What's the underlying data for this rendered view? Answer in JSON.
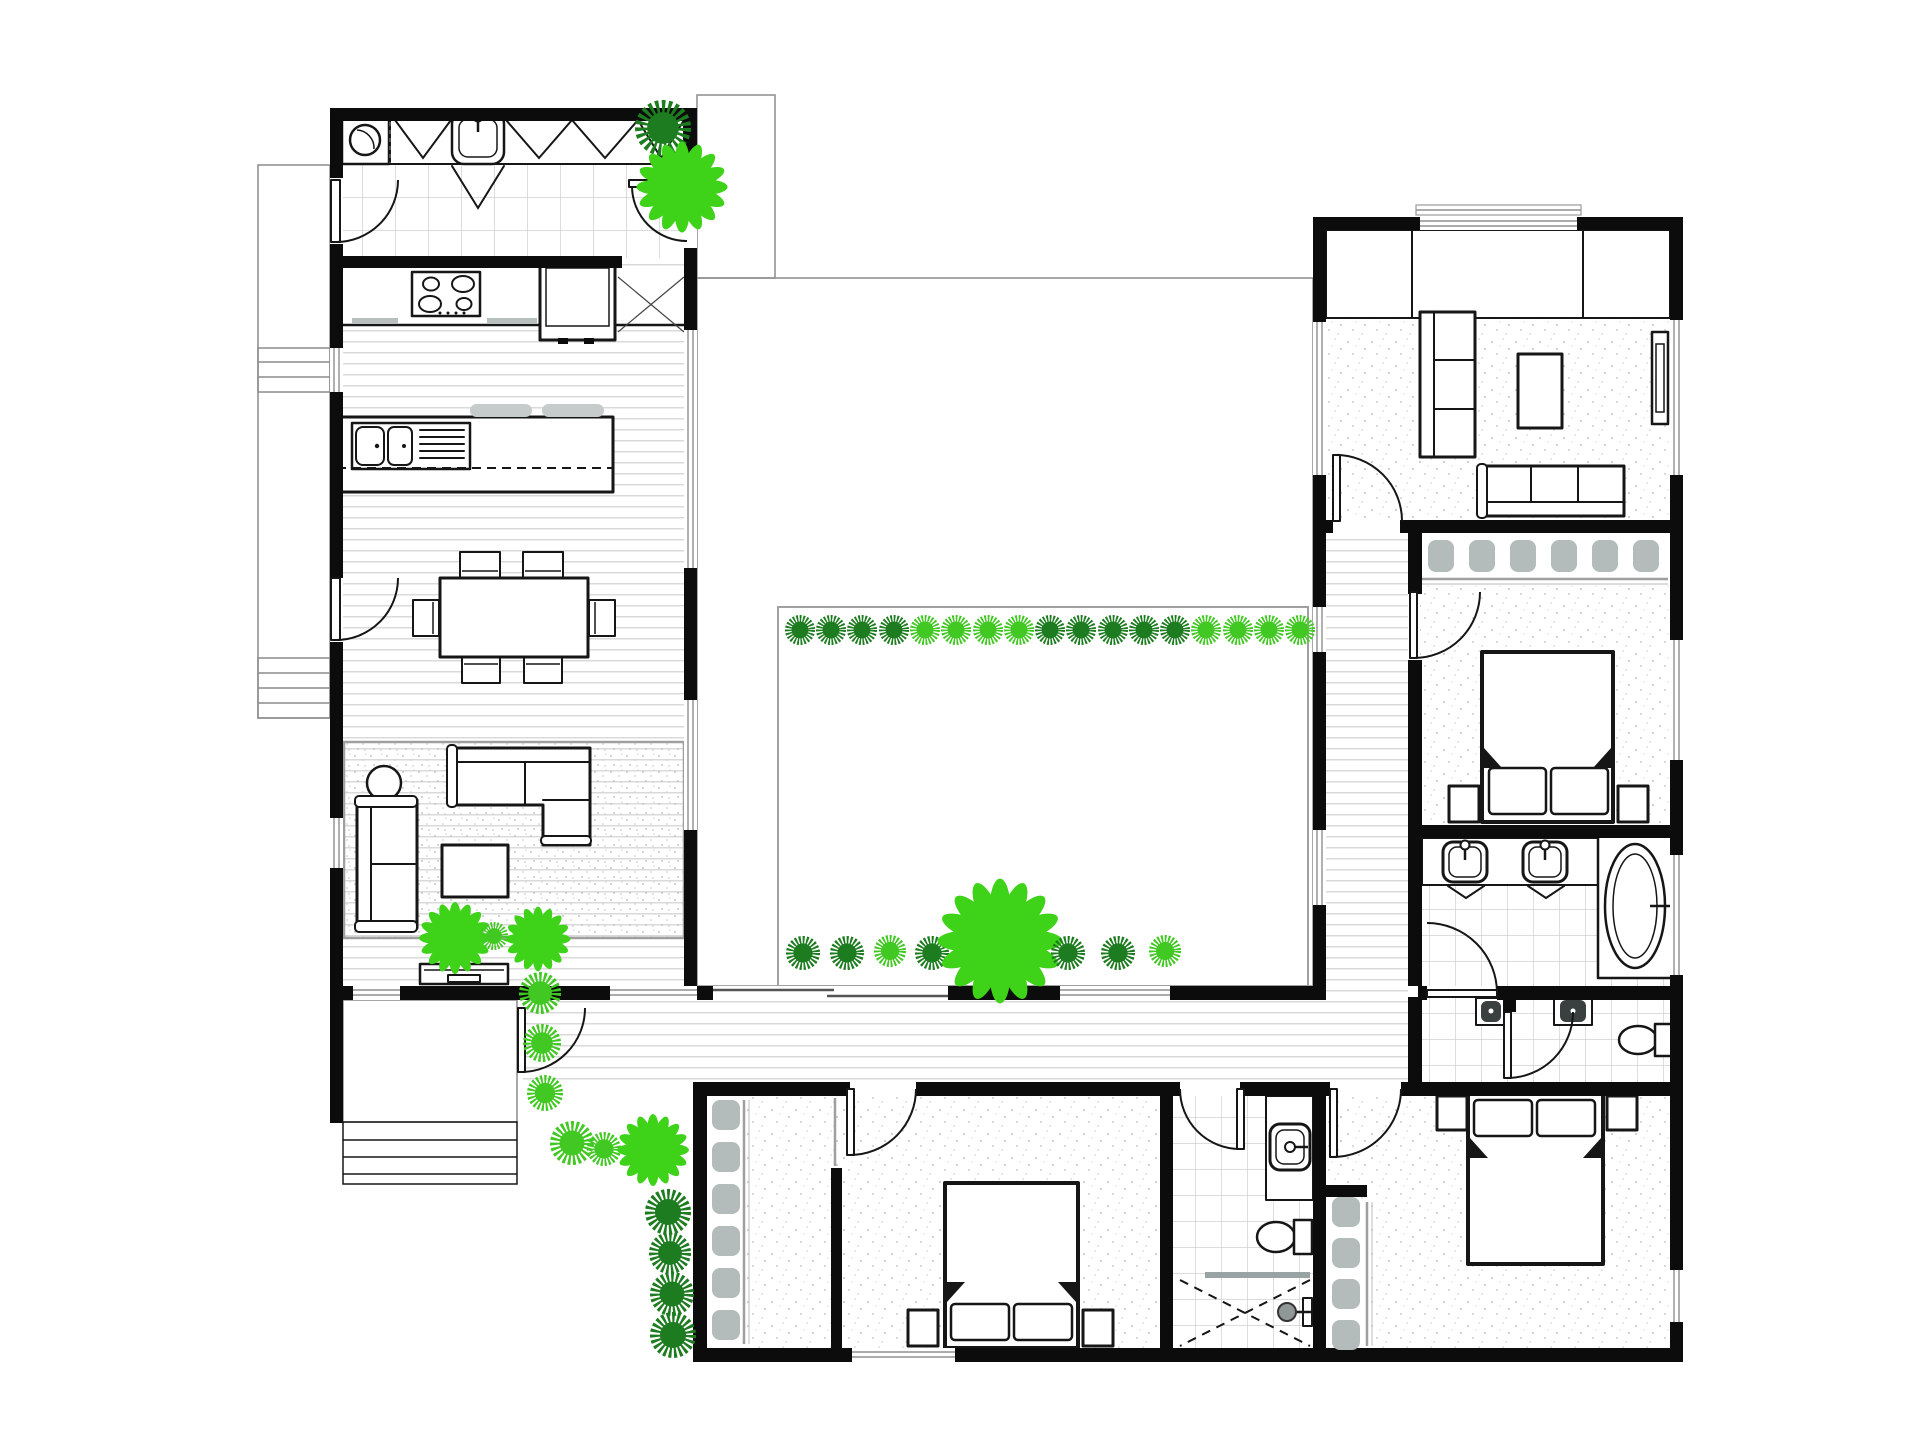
{
  "canvas": {
    "width": 1920,
    "height": 1440,
    "background": "#ffffff"
  },
  "palette": {
    "wall": "#0c0c0c",
    "line": "#161616",
    "glass": "#8f8f8f",
    "floor_line": "#dadada",
    "deck_line": "#c9c9c9",
    "tile_line": "#d0d0d0",
    "carpet_dot": "#cbcbcb",
    "gray_fixture": "#b4bbbb",
    "plant_dark": "#1d7c1f",
    "plant_light": "#41c822",
    "flower_light": "#3ed218"
  },
  "plants": [
    {
      "type": "bush",
      "shade": "dark",
      "x": 663,
      "y": 128,
      "r": 28
    },
    {
      "type": "flower",
      "shade": "light",
      "x": 682,
      "y": 187,
      "r": 38
    },
    {
      "type": "bush",
      "shade": "dark",
      "x": 800,
      "y": 630,
      "r": 15
    },
    {
      "type": "bush",
      "shade": "dark",
      "x": 831,
      "y": 630,
      "r": 15
    },
    {
      "type": "bush",
      "shade": "dark",
      "x": 862,
      "y": 630,
      "r": 15
    },
    {
      "type": "bush",
      "shade": "dark",
      "x": 894,
      "y": 630,
      "r": 15
    },
    {
      "type": "bush",
      "shade": "light",
      "x": 925,
      "y": 630,
      "r": 15
    },
    {
      "type": "bush",
      "shade": "light",
      "x": 956,
      "y": 630,
      "r": 15
    },
    {
      "type": "bush",
      "shade": "light",
      "x": 988,
      "y": 630,
      "r": 15
    },
    {
      "type": "bush",
      "shade": "light",
      "x": 1019,
      "y": 630,
      "r": 15
    },
    {
      "type": "bush",
      "shade": "dark",
      "x": 1050,
      "y": 630,
      "r": 15
    },
    {
      "type": "bush",
      "shade": "dark",
      "x": 1081,
      "y": 630,
      "r": 15
    },
    {
      "type": "bush",
      "shade": "dark",
      "x": 1113,
      "y": 630,
      "r": 15
    },
    {
      "type": "bush",
      "shade": "dark",
      "x": 1144,
      "y": 630,
      "r": 15
    },
    {
      "type": "bush",
      "shade": "dark",
      "x": 1175,
      "y": 630,
      "r": 15
    },
    {
      "type": "bush",
      "shade": "light",
      "x": 1206,
      "y": 630,
      "r": 15
    },
    {
      "type": "bush",
      "shade": "light",
      "x": 1238,
      "y": 630,
      "r": 15
    },
    {
      "type": "bush",
      "shade": "light",
      "x": 1269,
      "y": 630,
      "r": 15
    },
    {
      "type": "bush",
      "shade": "light",
      "x": 1300,
      "y": 630,
      "r": 15
    },
    {
      "type": "bush",
      "shade": "dark",
      "x": 803,
      "y": 953,
      "r": 17
    },
    {
      "type": "bush",
      "shade": "dark",
      "x": 847,
      "y": 953,
      "r": 17
    },
    {
      "type": "bush",
      "shade": "light",
      "x": 890,
      "y": 951,
      "r": 16
    },
    {
      "type": "bush",
      "shade": "dark",
      "x": 932,
      "y": 953,
      "r": 17
    },
    {
      "type": "flower",
      "shade": "light",
      "x": 1000,
      "y": 941,
      "r": 52
    },
    {
      "type": "bush",
      "shade": "dark",
      "x": 1068,
      "y": 953,
      "r": 17
    },
    {
      "type": "bush",
      "shade": "dark",
      "x": 1118,
      "y": 953,
      "r": 17
    },
    {
      "type": "bush",
      "shade": "light",
      "x": 1165,
      "y": 951,
      "r": 16
    },
    {
      "type": "flower",
      "shade": "light",
      "x": 455,
      "y": 938,
      "r": 30
    },
    {
      "type": "bush",
      "shade": "light",
      "x": 494,
      "y": 936,
      "r": 14
    },
    {
      "type": "flower",
      "shade": "light",
      "x": 538,
      "y": 939,
      "r": 27
    },
    {
      "type": "bush",
      "shade": "light",
      "x": 540,
      "y": 993,
      "r": 21
    },
    {
      "type": "bush",
      "shade": "light",
      "x": 542,
      "y": 1043,
      "r": 19
    },
    {
      "type": "bush",
      "shade": "light",
      "x": 545,
      "y": 1093,
      "r": 18
    },
    {
      "type": "bush",
      "shade": "light",
      "x": 572,
      "y": 1143,
      "r": 22
    },
    {
      "type": "bush",
      "shade": "light",
      "x": 604,
      "y": 1149,
      "r": 17
    },
    {
      "type": "flower",
      "shade": "light",
      "x": 653,
      "y": 1150,
      "r": 30
    },
    {
      "type": "bush",
      "shade": "dark",
      "x": 668,
      "y": 1212,
      "r": 23
    },
    {
      "type": "bush",
      "shade": "dark",
      "x": 670,
      "y": 1253,
      "r": 21
    },
    {
      "type": "bush",
      "shade": "dark",
      "x": 672,
      "y": 1294,
      "r": 22
    },
    {
      "type": "bush",
      "shade": "dark",
      "x": 673,
      "y": 1335,
      "r": 23
    }
  ],
  "wardrobes": [
    {
      "id": "master-robe",
      "orientation": "h",
      "x": 1441,
      "y": 556,
      "step": 41,
      "count": 6,
      "w": 26,
      "h": 32
    },
    {
      "id": "bedroom2-robe",
      "orientation": "v",
      "x": 726,
      "y": 1115,
      "step": 42,
      "count": 6,
      "w": 28,
      "h": 30
    },
    {
      "id": "bedroom3-robe",
      "orientation": "v",
      "x": 1346,
      "y": 1212,
      "step": 41,
      "count": 4,
      "w": 28,
      "h": 30
    }
  ]
}
